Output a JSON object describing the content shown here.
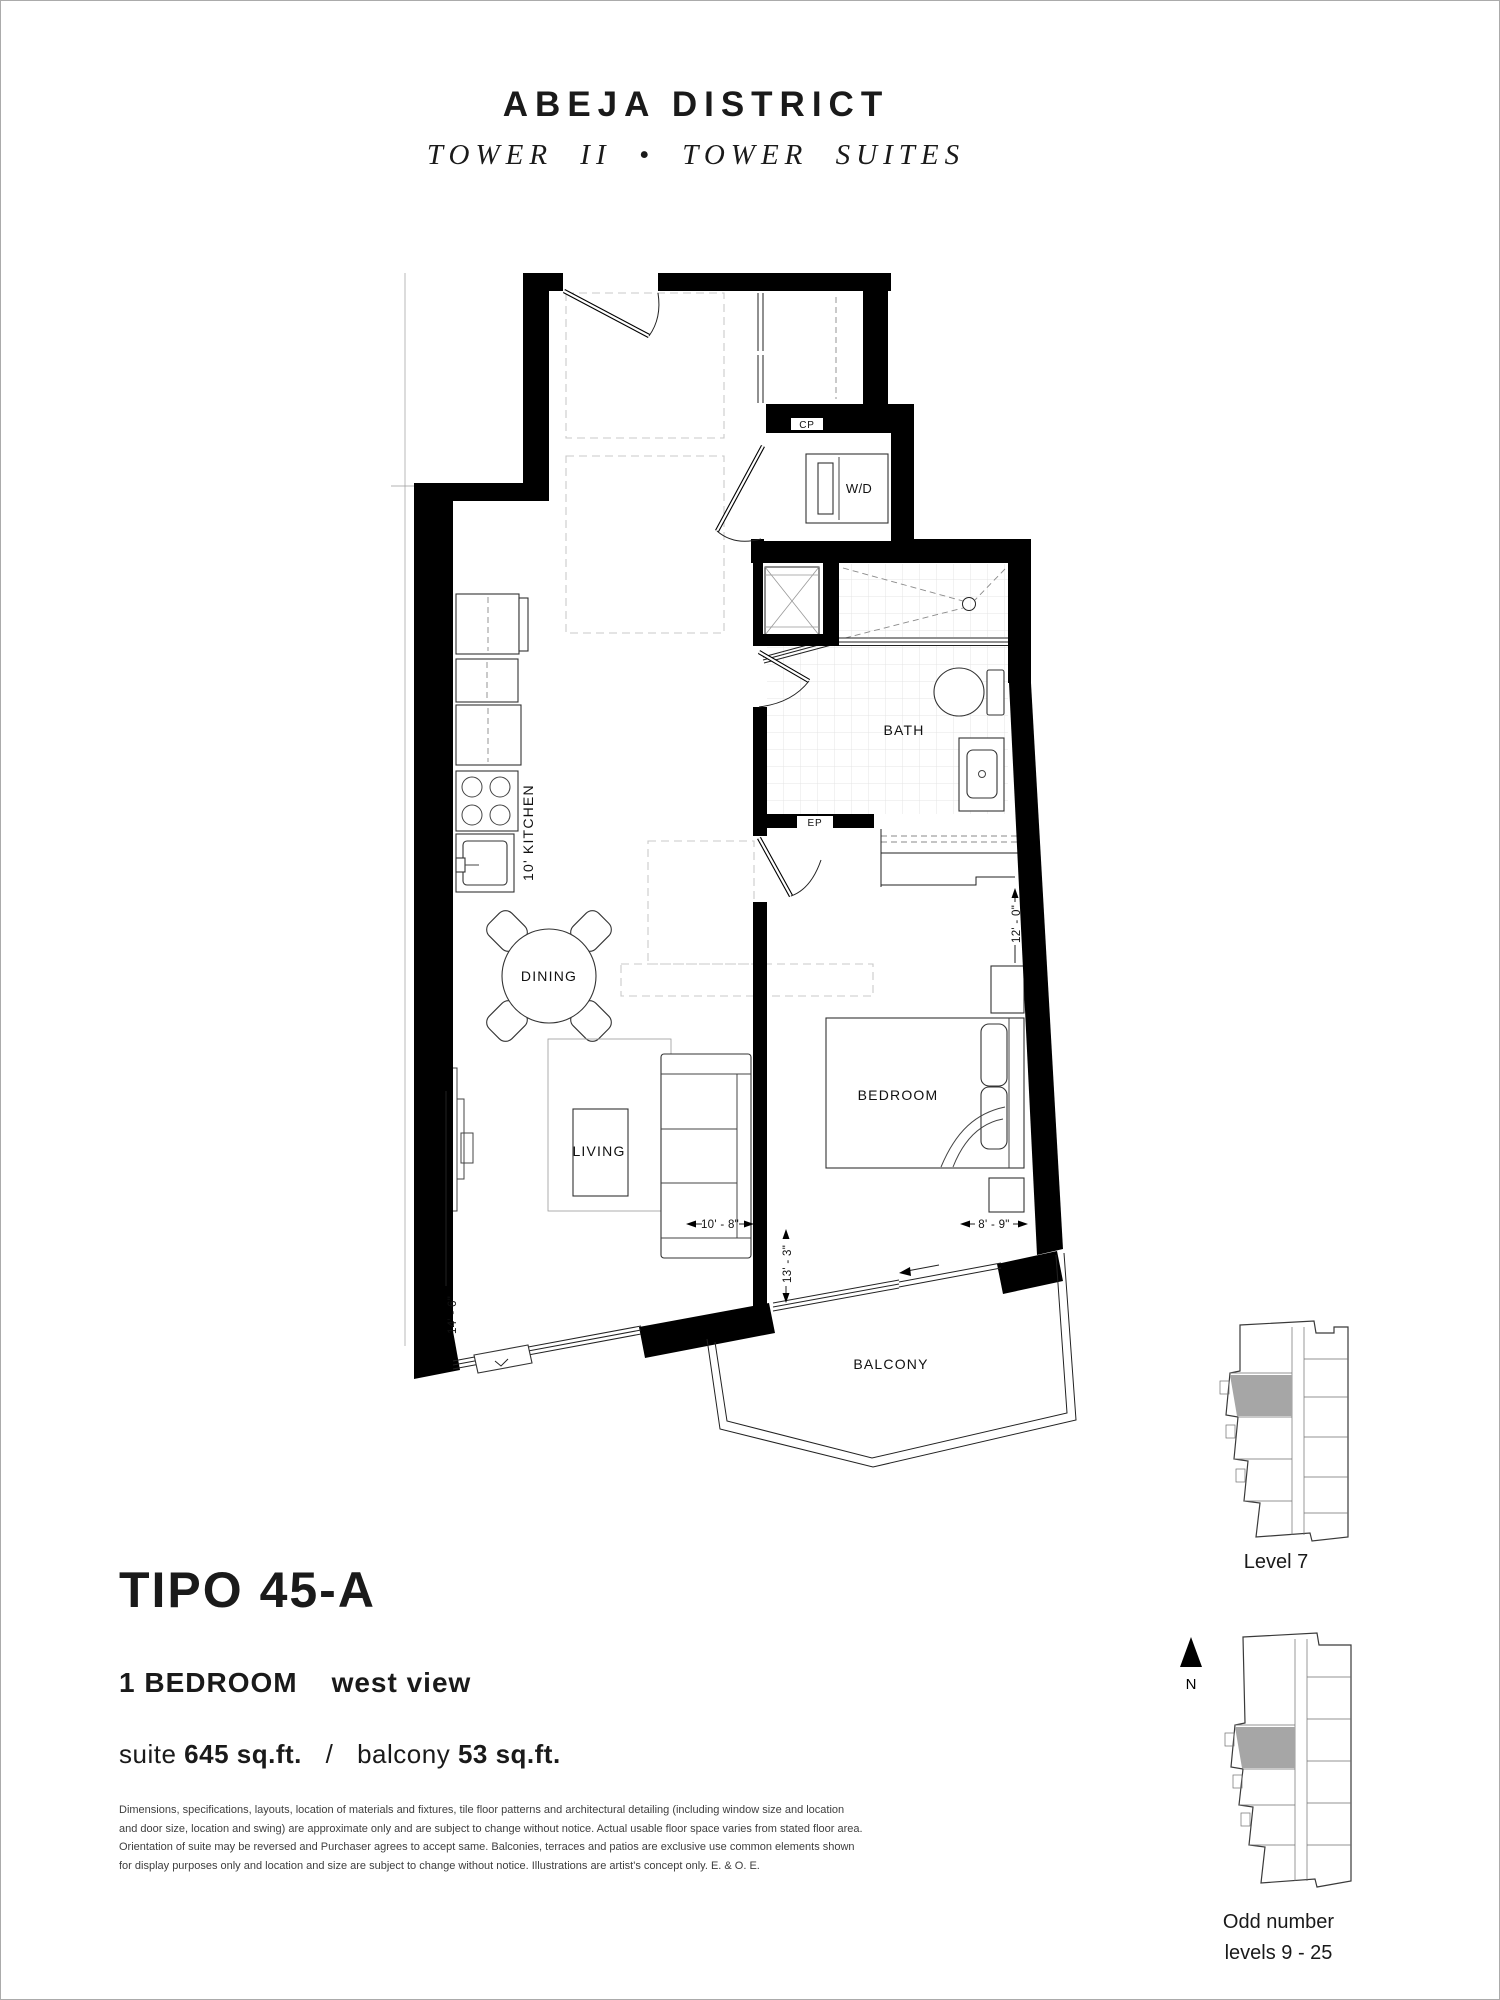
{
  "header": {
    "brand": "ABEJA DISTRICT",
    "subbrand": "TOWER II • TOWER SUITES"
  },
  "plan": {
    "labels": {
      "entry_closet": "CP",
      "washer_dryer": "W/D",
      "bath": "BATH",
      "electrical_panel": "EP",
      "kitchen": "10'  KITCHEN",
      "dining": "DINING",
      "living": "LIVING",
      "bedroom": "BEDROOM",
      "balcony": "BALCONY"
    },
    "dimensions": {
      "left_wall": "14' - 6\"",
      "living_width": "10' - 8\"",
      "living_depth": "13' - 3\"",
      "bedroom_width": "8' - 9\"",
      "bedroom_depth": "12' - 0\""
    }
  },
  "suite": {
    "plan_name": "TIPO 45-A",
    "bedrooms": "1 BEDROOM",
    "view": "west view",
    "suite_label": "suite",
    "suite_area": "645 sq.ft.",
    "divider": "/",
    "balcony_label": "balcony",
    "balcony_area": "53 sq.ft."
  },
  "disclaimer": {
    "line1": "Dimensions, specifications, layouts, location of materials and fixtures, tile floor patterns and architectural detailing (including window size and location",
    "line2": "and door size, location and swing) are approximate only and are subject to change without notice. Actual usable floor space varies from stated floor area.",
    "line3": "Orientation of suite may be reversed and Purchaser agrees to accept same. Balconies, terraces and patios are exclusive use common elements shown",
    "line4": "for display purposes only and location and size are subject to change without notice. Illustrations are artist's concept only. E. & O. E."
  },
  "keyplans": {
    "level7_label": "Level 7",
    "north_label": "N",
    "odd_label_line1": "Odd number",
    "odd_label_line2": "levels 9 - 25"
  }
}
